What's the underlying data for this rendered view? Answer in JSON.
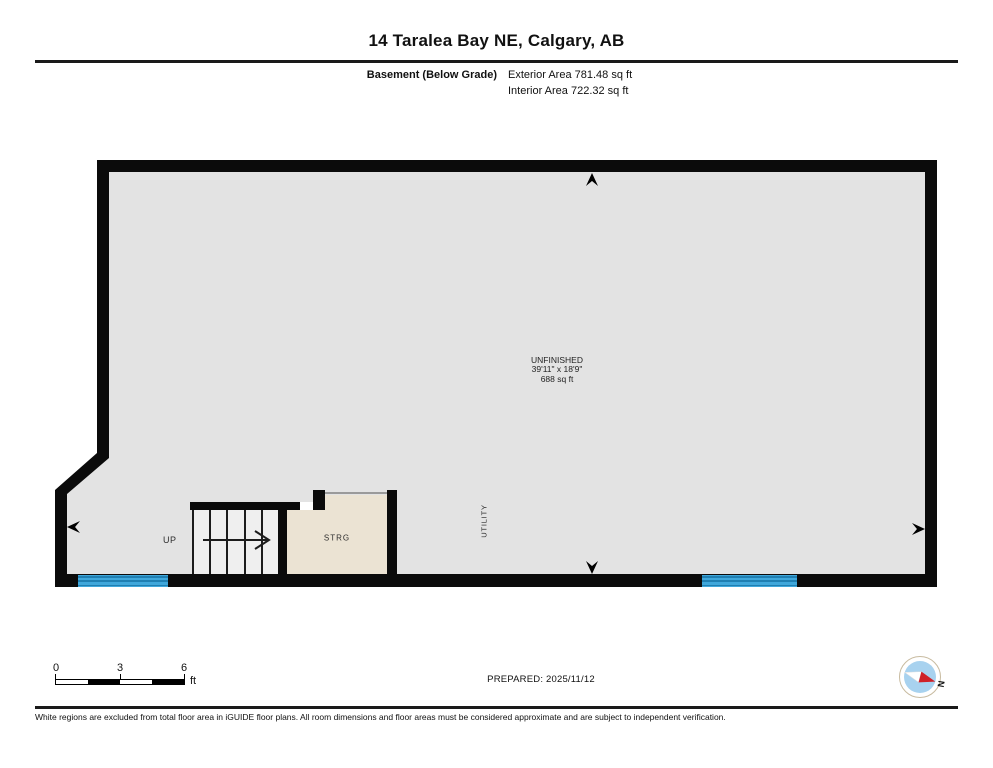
{
  "header": {
    "title": "14 Taralea Bay NE, Calgary, AB",
    "floor_label": "Basement (Below Grade)",
    "exterior_area": "Exterior Area 781.48 sq ft",
    "interior_area": "Interior Area 722.32 sq ft"
  },
  "plan": {
    "room_unfinished": {
      "name": "UNFINISHED",
      "dimensions": "39'11\" x 18'9\"",
      "area": "688 sq ft"
    },
    "stairs_label": "UP",
    "storage_label": "STRG",
    "utility_label": "UTILITY"
  },
  "scale_bar": {
    "ticks": [
      "0",
      "3",
      "6"
    ],
    "unit": "ft"
  },
  "prepared_label": "PREPARED: 2025/11/12",
  "compass": {
    "north_label": "N"
  },
  "footer_note": "White regions are excluded from total floor area in iGUIDE floor plans. All room dimensions and floor areas must be considered approximate and are subject to independent verification.",
  "colors": {
    "wall": "#0b0b0b",
    "floor": "#e3e3e3",
    "stairs": "#efefef",
    "storage": "#ebe3d3",
    "window": "#3fa7db",
    "window_stripe": "#1f7fb2",
    "compass_fill": "#a8d2ef",
    "compass_ring": "#c8bba0",
    "compass_needle": "#cf2128",
    "opening_line": "#9a9a9a"
  }
}
